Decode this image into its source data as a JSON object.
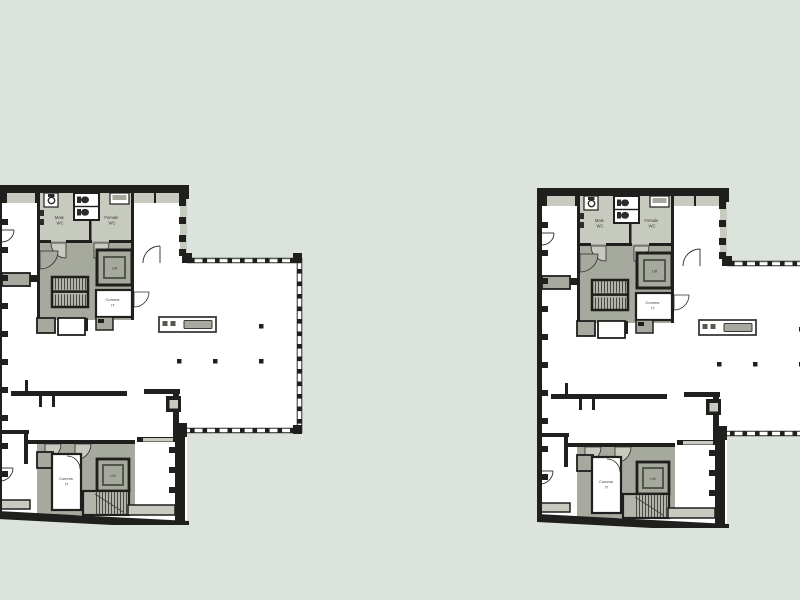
{
  "canvas": {
    "width": 800,
    "height": 600
  },
  "palette": {
    "bg": "#dbe3dc",
    "wall": "#1f1f1d",
    "room_light": "#c7cabf",
    "room_mid": "#a6a99d",
    "stair": "#b2b5a9",
    "lift_inner": "#53564c",
    "counter_dark": "#55584e",
    "white": "#ffffff",
    "label": "#3a3a38",
    "thin_line": "#2c2c2a"
  },
  "plans": [
    {
      "name": "floor-plan-left"
    },
    {
      "name": "floor-plan-right"
    }
  ],
  "plan_labels": {
    "male_wc": [
      "Male",
      "WC"
    ],
    "female_wc": [
      "Female",
      "WC"
    ],
    "lift_upper": "Lift",
    "comms_upper": [
      "Comms",
      "IT"
    ],
    "lift_lower": "Lift",
    "comms_lower": [
      "Comms",
      "IT"
    ]
  }
}
